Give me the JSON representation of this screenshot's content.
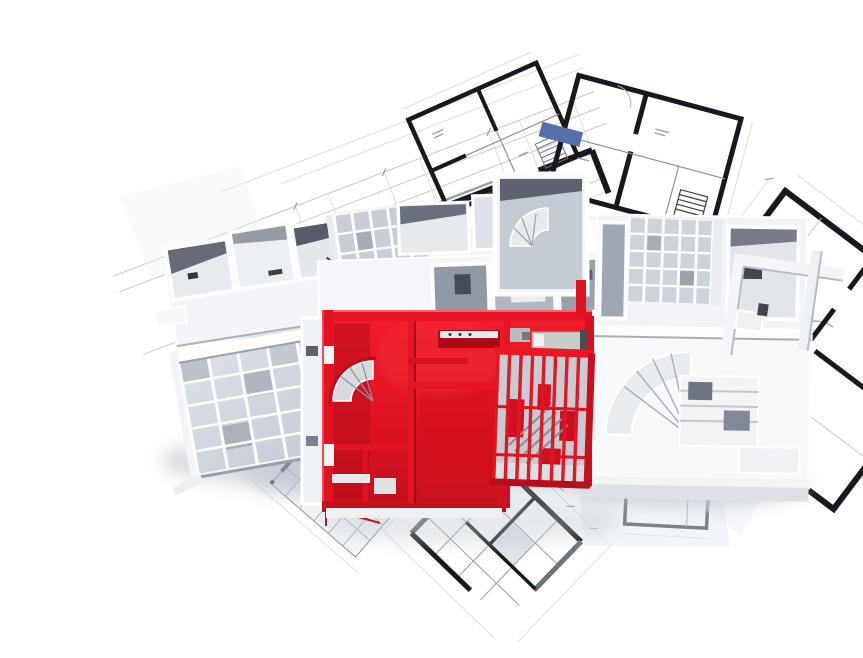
{
  "scene": {
    "type": "3d-architectural-floor-plan-render",
    "description": "Aerial 3D render of a white architectural floor-plan model standing on scattered 2D blueprint drawings; one apartment unit and its pergola grid are highlighted in bright red, and one room on a background blueprint is highlighted in slate blue.",
    "background": "#ffffff",
    "palette": {
      "model_white": "#f4f6f8",
      "model_shadow": "#9aa2ac",
      "glass_gray": "#ccd3da",
      "room_dark": "#8e96a1",
      "highlight_red": "#e61424",
      "highlight_red_dark": "#b30e1c",
      "highlight_red_bright": "#ff5560",
      "accent_blue": "#5570a8",
      "blueprint_line": "#b6bfca",
      "blueprint_wall": "#16191f",
      "shadow": "#aeb6c2"
    },
    "components": {
      "blueprints": "scattered 2D plan sheets with black walls and dimension lines",
      "white_model": "3D white apartment model with skylight grids and spiral stairs",
      "red_unit": "highlighted red apartment with red pergola grid",
      "blue_room": "blue highlighted room on upper-right blueprint"
    }
  }
}
